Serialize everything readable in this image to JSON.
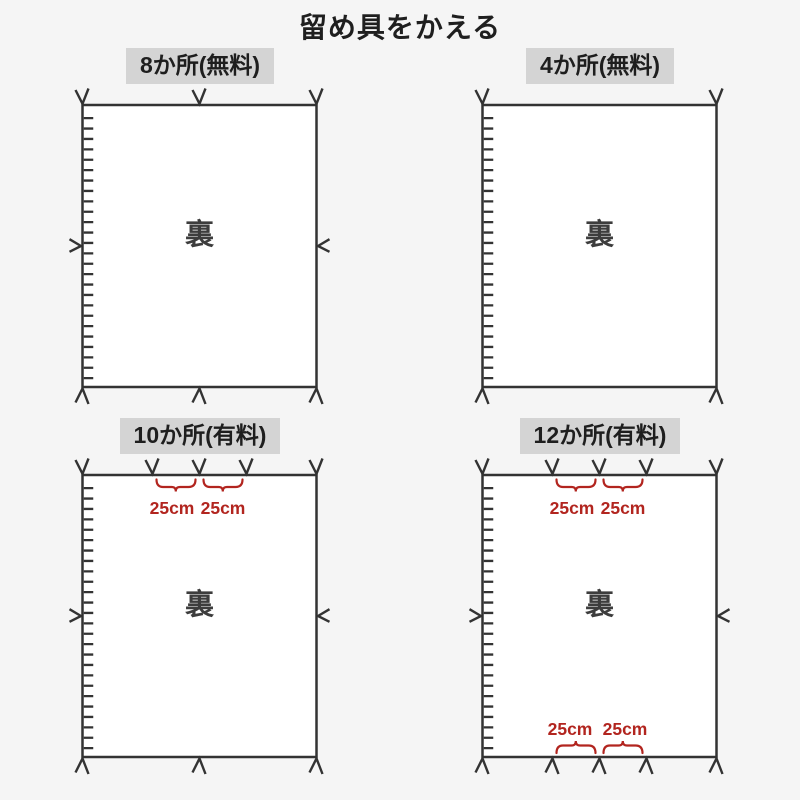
{
  "title": "留め具をかえる",
  "colors": {
    "page_bg": "#f5f5f5",
    "line": "#333333",
    "label_bg": "#d4d4d4",
    "dimension_red": "#b2251f",
    "back_text": "#3d3d3d"
  },
  "panels": [
    {
      "label": "8か所(無料)",
      "back_label": "裏",
      "marks": {
        "top": 3,
        "bottom": 3,
        "left": 1,
        "right": 1
      }
    },
    {
      "label": "4か所(無料)",
      "back_label": "裏",
      "marks": {
        "top": 2,
        "bottom": 2,
        "left": 0,
        "right": 0
      }
    },
    {
      "label": "10か所(有料)",
      "back_label": "裏",
      "marks": {
        "top": 5,
        "bottom": 3,
        "left": 1,
        "right": 1
      },
      "dimensions_top": [
        "25cm",
        "25cm"
      ]
    },
    {
      "label": "12か所(有料)",
      "back_label": "裏",
      "marks": {
        "top": 5,
        "bottom": 5,
        "left": 1,
        "right": 1
      },
      "dimensions_top": [
        "25cm",
        "25cm"
      ],
      "dimensions_bottom": [
        "25cm",
        "25cm"
      ]
    }
  ]
}
